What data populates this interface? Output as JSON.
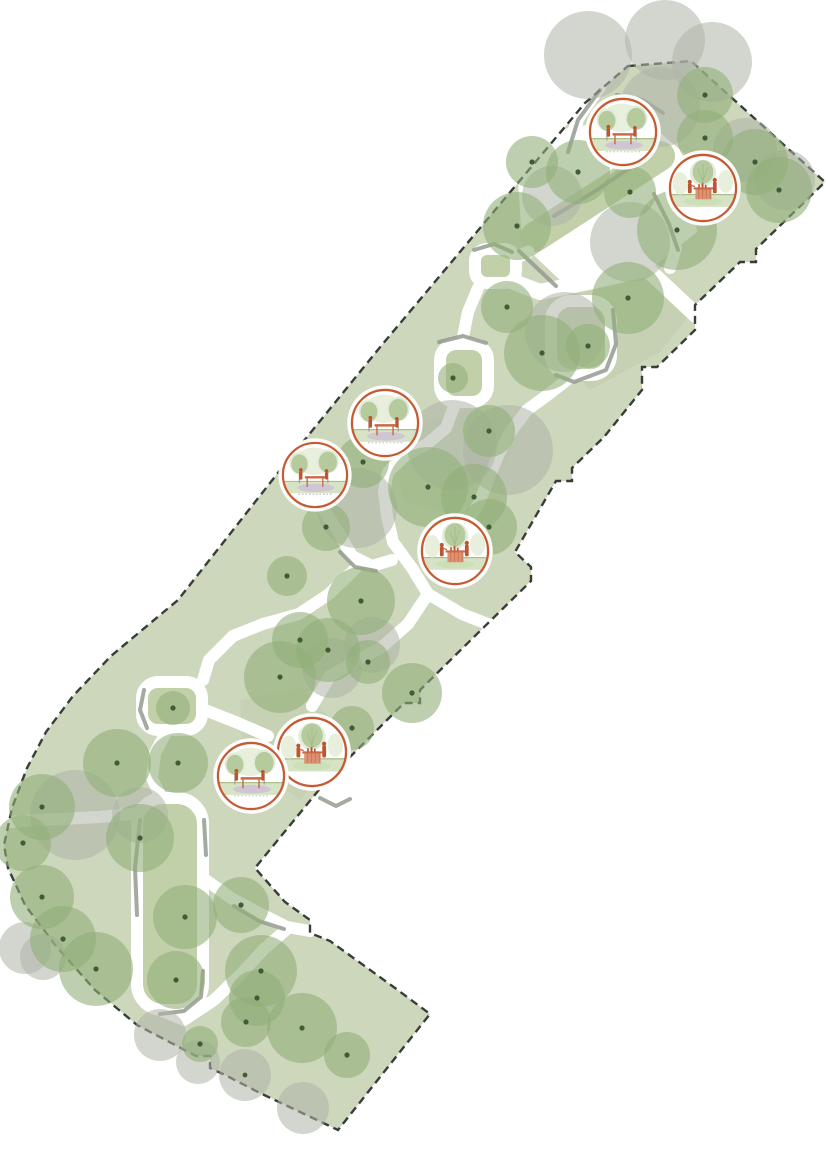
{
  "meta": {
    "type": "landscape-site-plan",
    "description": "Park open-space design plan: diagonal green site with dashed property boundary, tree planting, looping white footpaths and seven amenity vignette callouts",
    "canvas": {
      "w": 828,
      "h": 1171
    }
  },
  "colors": {
    "background": "#ffffff",
    "base": "#cdd7bc",
    "island": "#c2d0aa",
    "meadow": "#9cb581",
    "treeGreen": "#91af78",
    "treeGreenOpacity": 0.6,
    "treeGray": "#afb4a7",
    "treeGrayOpacity": 0.55,
    "dot": "#3f5c38",
    "dash": "#383e37",
    "grayArc": "#949a90",
    "pathWhite": "#ffffff",
    "ring": "#c65a33",
    "figure": "#bf5430",
    "tableWood": "#cb6a45",
    "counterFill": "#dd9273",
    "counterStripe": "#c97a52",
    "halo": "#e3ecd8",
    "vigTree": "#b5cb9e",
    "vigTreeFaint": "#e8efdd",
    "trunk": "#a8a094",
    "grassBand": "#d7e3c5",
    "grassLine": "#a9bf8c",
    "lavender": "#cfc5d3",
    "dotted": "#c2b6c6",
    "groundGreen": "#cbdfb8",
    "branch": "#9cb681"
  },
  "boundary": {
    "dash": "8 5",
    "width": 2.4,
    "points": [
      [
        628,
        66
      ],
      [
        691,
        61
      ],
      [
        825,
        182
      ],
      [
        756,
        249
      ],
      [
        756,
        262
      ],
      [
        740,
        262
      ],
      [
        695,
        305
      ],
      [
        695,
        330
      ],
      [
        657,
        367
      ],
      [
        642,
        367
      ],
      [
        642,
        390
      ],
      [
        604,
        437
      ],
      [
        572,
        468
      ],
      [
        572,
        481
      ],
      [
        556,
        481
      ],
      [
        515,
        552
      ],
      [
        531,
        567
      ],
      [
        531,
        581
      ],
      [
        480,
        631
      ],
      [
        420,
        690
      ],
      [
        420,
        703
      ],
      [
        404,
        703
      ],
      [
        327,
        780
      ],
      [
        255,
        868
      ],
      [
        285,
        902
      ],
      [
        310,
        920
      ],
      [
        310,
        933
      ],
      [
        330,
        941
      ],
      [
        395,
        988
      ],
      [
        430,
        1014
      ],
      [
        338,
        1130
      ],
      [
        260,
        1093
      ],
      [
        225,
        1075
      ],
      [
        210,
        1068
      ],
      [
        210,
        1056
      ],
      [
        196,
        1056
      ],
      [
        137,
        1025
      ],
      [
        95,
        990
      ],
      [
        55,
        945
      ],
      [
        25,
        905
      ],
      [
        8,
        868
      ],
      [
        4,
        845
      ],
      [
        12,
        808
      ],
      [
        27,
        768
      ],
      [
        46,
        732
      ],
      [
        73,
        696
      ],
      [
        111,
        656
      ],
      [
        178,
        600
      ],
      [
        281,
        469
      ],
      [
        381,
        346
      ],
      [
        585,
        103
      ]
    ]
  },
  "clearing": {
    "points": [
      [
        545,
        132
      ],
      [
        640,
        116
      ],
      [
        690,
        158
      ],
      [
        697,
        232
      ],
      [
        642,
        276
      ],
      [
        562,
        282
      ],
      [
        522,
        244
      ],
      [
        518,
        180
      ]
    ]
  },
  "island_strip": {
    "from": [
      660,
      156
    ],
    "to": [
      535,
      237
    ],
    "width": 30
  },
  "meadows": [
    {
      "pts": [
        [
          548,
          298
        ],
        [
          640,
          272
        ],
        [
          692,
          312
        ],
        [
          660,
          352
        ],
        [
          590,
          390
        ],
        [
          548,
          338
        ]
      ],
      "opacity": 0.16
    },
    {
      "pts": [
        [
          395,
          430
        ],
        [
          470,
          408
        ],
        [
          512,
          450
        ],
        [
          472,
          522
        ],
        [
          402,
          500
        ]
      ],
      "opacity": 0.14
    },
    {
      "pts": [
        [
          240,
          700
        ],
        [
          300,
          688
        ],
        [
          352,
          740
        ],
        [
          300,
          800
        ],
        [
          243,
          760
        ]
      ],
      "opacity": 0.12
    }
  ],
  "paths": [
    {
      "pts": [
        [
          600,
          86
        ],
        [
          578,
          118
        ],
        [
          568,
          150
        ],
        [
          577,
          180
        ]
      ],
      "w": 13
    },
    {
      "pts": [
        [
          498,
          276
        ],
        [
          540,
          292
        ],
        [
          593,
          281
        ],
        [
          647,
          269
        ],
        [
          696,
          315
        ]
      ],
      "w": 16
    },
    {
      "pts": [
        [
          528,
          252
        ],
        [
          506,
          262
        ],
        [
          492,
          266
        ]
      ],
      "w": 13
    },
    {
      "pts": [
        [
          478,
          288
        ],
        [
          468,
          312
        ],
        [
          462,
          342
        ]
      ],
      "w": 12
    },
    {
      "pts": [
        [
          455,
          404
        ],
        [
          446,
          428
        ],
        [
          427,
          444
        ],
        [
          405,
          456
        ],
        [
          388,
          472
        ],
        [
          384,
          492
        ],
        [
          387,
          516
        ]
      ],
      "w": 12
    },
    {
      "pts": [
        [
          387,
          516
        ],
        [
          393,
          542
        ],
        [
          412,
          568
        ],
        [
          428,
          594
        ],
        [
          408,
          624
        ],
        [
          382,
          647
        ],
        [
          356,
          661
        ],
        [
          330,
          676
        ],
        [
          312,
          706
        ]
      ],
      "w": 12
    },
    {
      "pts": [
        [
          428,
          594
        ],
        [
          462,
          614
        ],
        [
          498,
          628
        ]
      ],
      "w": 12
    },
    {
      "pts": [
        [
          320,
          504
        ],
        [
          337,
          530
        ],
        [
          352,
          556
        ],
        [
          372,
          566
        ],
        [
          392,
          560
        ]
      ],
      "w": 12
    },
    {
      "pts": [
        [
          356,
          568
        ],
        [
          329,
          594
        ],
        [
          299,
          614
        ],
        [
          263,
          624
        ],
        [
          233,
          636
        ],
        [
          209,
          660
        ],
        [
          203,
          680
        ]
      ],
      "w": 12
    },
    {
      "pts": [
        [
          205,
          710
        ],
        [
          238,
          723
        ],
        [
          268,
          736
        ]
      ],
      "w": 12
    },
    {
      "pts": [
        [
          169,
          727
        ],
        [
          155,
          753
        ],
        [
          152,
          778
        ],
        [
          160,
          795
        ]
      ],
      "w": 12
    },
    {
      "pts": [
        [
          188,
          804
        ],
        [
          150,
          812
        ],
        [
          100,
          817
        ],
        [
          40,
          820
        ],
        [
          10,
          822
        ]
      ],
      "w": 12
    },
    {
      "pts": [
        [
          330,
          762
        ],
        [
          343,
          782
        ],
        [
          337,
          803
        ],
        [
          324,
          813
        ]
      ],
      "w": 12
    },
    {
      "pts": [
        [
          203,
          878
        ],
        [
          231,
          898
        ],
        [
          259,
          913
        ],
        [
          287,
          927
        ],
        [
          310,
          931
        ]
      ],
      "w": 12
    },
    {
      "pts": [
        [
          155,
          1008
        ],
        [
          184,
          1020
        ],
        [
          214,
          1000
        ],
        [
          241,
          974
        ],
        [
          264,
          949
        ],
        [
          287,
          929
        ]
      ],
      "w": 12
    },
    {
      "pts": [
        [
          655,
          195
        ],
        [
          668,
          222
        ],
        [
          676,
          248
        ],
        [
          670,
          268
        ]
      ],
      "w": 12
    },
    {
      "pts": [
        [
          572,
          376
        ],
        [
          549,
          394
        ],
        [
          527,
          410
        ],
        [
          509,
          434
        ],
        [
          498,
          456
        ],
        [
          478,
          505
        ],
        [
          466,
          524
        ]
      ],
      "w": 12
    }
  ],
  "loops": [
    {
      "x": 475,
      "y": 249,
      "w": 41,
      "h": 34,
      "rx": 12
    },
    {
      "x": 440,
      "y": 344,
      "w": 48,
      "h": 58,
      "rx": 16
    },
    {
      "x": 551,
      "y": 301,
      "w": 60,
      "h": 74,
      "rx": 20
    },
    {
      "x": 142,
      "y": 682,
      "w": 60,
      "h": 48,
      "rx": 16
    },
    {
      "x": 137,
      "y": 798,
      "w": 66,
      "h": 212,
      "rx": 26
    }
  ],
  "arcs": [
    {
      "pts": [
        [
          600,
          90
        ],
        [
          578,
          120
        ],
        [
          568,
          152
        ]
      ]
    },
    {
      "pts": [
        [
          641,
          160
        ],
        [
          597,
          190
        ],
        [
          554,
          216
        ]
      ]
    },
    {
      "pts": [
        [
          519,
          251
        ],
        [
          539,
          270
        ],
        [
          556,
          286
        ]
      ]
    },
    {
      "pts": [
        [
          474,
          250
        ],
        [
          494,
          244
        ],
        [
          512,
          252
        ]
      ]
    },
    {
      "pts": [
        [
          613,
          310
        ],
        [
          616,
          344
        ],
        [
          606,
          370
        ],
        [
          574,
          382
        ],
        [
          556,
          375
        ]
      ]
    },
    {
      "pts": [
        [
          439,
          342
        ],
        [
          463,
          336
        ],
        [
          486,
          343
        ]
      ]
    },
    {
      "pts": [
        [
          340,
          552
        ],
        [
          355,
          567
        ],
        [
          376,
          571
        ]
      ]
    },
    {
      "pts": [
        [
          144,
          690
        ],
        [
          140,
          710
        ],
        [
          147,
          728
        ]
      ]
    },
    {
      "pts": [
        [
          140,
          820
        ],
        [
          135,
          868
        ],
        [
          137,
          915
        ]
      ]
    },
    {
      "pts": [
        [
          203,
          971
        ],
        [
          201,
          997
        ],
        [
          184,
          1011
        ],
        [
          160,
          1014
        ]
      ]
    },
    {
      "pts": [
        [
          654,
          194
        ],
        [
          669,
          224
        ],
        [
          678,
          250
        ]
      ]
    },
    {
      "pts": [
        [
          224,
          792
        ],
        [
          249,
          805
        ],
        [
          274,
          798
        ]
      ]
    },
    {
      "pts": [
        [
          234,
          906
        ],
        [
          259,
          921
        ],
        [
          284,
          929
        ]
      ]
    },
    {
      "pts": [
        [
          431,
          566
        ],
        [
          456,
          575
        ],
        [
          479,
          567
        ]
      ]
    },
    {
      "pts": [
        [
          204,
          820
        ],
        [
          206,
          855
        ]
      ]
    },
    {
      "pts": [
        [
          617,
          95
        ],
        [
          643,
          100
        ],
        [
          663,
          113
        ]
      ]
    },
    {
      "pts": [
        [
          320,
          798
        ],
        [
          336,
          806
        ],
        [
          350,
          799
        ]
      ]
    }
  ],
  "trees": [
    [
      705,
      95,
      28
    ],
    [
      705,
      138,
      28
    ],
    [
      755,
      162,
      33
    ],
    [
      779,
      190,
      33
    ],
    [
      677,
      230,
      40
    ],
    [
      630,
      192,
      26
    ],
    [
      578,
      172,
      32
    ],
    [
      532,
      162,
      26
    ],
    [
      517,
      226,
      34
    ],
    [
      628,
      298,
      36
    ],
    [
      507,
      307,
      26
    ],
    [
      542,
      353,
      38
    ],
    [
      588,
      346,
      22
    ],
    [
      453,
      378,
      15
    ],
    [
      489,
      431,
      26
    ],
    [
      428,
      487,
      40
    ],
    [
      474,
      497,
      33
    ],
    [
      363,
      462,
      26
    ],
    [
      326,
      527,
      24
    ],
    [
      287,
      576,
      20
    ],
    [
      489,
      527,
      28
    ],
    [
      361,
      601,
      34
    ],
    [
      328,
      650,
      32
    ],
    [
      300,
      640,
      28
    ],
    [
      280,
      677,
      36
    ],
    [
      368,
      662,
      22
    ],
    [
      412,
      693,
      30
    ],
    [
      352,
      728,
      22
    ],
    [
      117,
      763,
      34
    ],
    [
      178,
      763,
      30
    ],
    [
      173,
      708,
      17
    ],
    [
      42,
      807,
      33
    ],
    [
      23,
      843,
      28
    ],
    [
      42,
      897,
      32
    ],
    [
      63,
      939,
      33
    ],
    [
      96,
      969,
      37
    ],
    [
      140,
      838,
      34
    ],
    [
      185,
      917,
      32
    ],
    [
      176,
      980,
      29
    ],
    [
      241,
      905,
      28
    ],
    [
      261,
      971,
      36
    ],
    [
      246,
      1022,
      25
    ],
    [
      257,
      998,
      28
    ],
    [
      302,
      1028,
      35
    ],
    [
      347,
      1055,
      23
    ],
    [
      200,
      1044,
      18
    ]
  ],
  "gray_trees": [
    [
      588,
      55,
      44,
      0
    ],
    [
      665,
      40,
      40,
      0
    ],
    [
      712,
      62,
      40,
      0
    ],
    [
      660,
      107,
      40,
      0
    ],
    [
      630,
      242,
      40,
      0
    ],
    [
      745,
      150,
      32,
      0
    ],
    [
      785,
      180,
      30,
      0
    ],
    [
      552,
      196,
      30,
      0
    ],
    [
      565,
      332,
      40,
      0
    ],
    [
      508,
      450,
      45,
      0
    ],
    [
      452,
      445,
      45,
      0
    ],
    [
      357,
      508,
      40,
      0
    ],
    [
      372,
      645,
      28,
      0
    ],
    [
      332,
      668,
      30,
      0
    ],
    [
      75,
      815,
      45,
      0
    ],
    [
      140,
      815,
      28,
      0
    ],
    [
      43,
      957,
      23,
      0
    ],
    [
      25,
      948,
      26,
      0
    ],
    [
      160,
      1035,
      26,
      0
    ],
    [
      198,
      1062,
      22,
      0
    ],
    [
      245,
      1075,
      26,
      1
    ],
    [
      303,
      1108,
      26,
      0
    ]
  ],
  "callouts": [
    {
      "x": 623,
      "y": 132,
      "r": 34,
      "type": "picnic-table",
      "scene": "two people at a picnic table between trees"
    },
    {
      "x": 703,
      "y": 188,
      "r": 34,
      "type": "kiosk",
      "scene": "two people at a garden kiosk counter under a tree"
    },
    {
      "x": 385,
      "y": 423,
      "r": 34,
      "type": "picnic-table",
      "scene": "two people at a picnic table between trees"
    },
    {
      "x": 315,
      "y": 475,
      "r": 33,
      "type": "picnic-table",
      "scene": "two people at a picnic table between trees"
    },
    {
      "x": 455,
      "y": 551,
      "r": 34,
      "type": "kiosk",
      "scene": "two people at a garden kiosk counter under a tree"
    },
    {
      "x": 312,
      "y": 752,
      "r": 35,
      "type": "kiosk",
      "scene": "two people at a garden kiosk counter under a tree"
    },
    {
      "x": 251,
      "y": 776,
      "r": 34,
      "type": "picnic-table",
      "scene": "two people at a picnic table between trees"
    }
  ]
}
